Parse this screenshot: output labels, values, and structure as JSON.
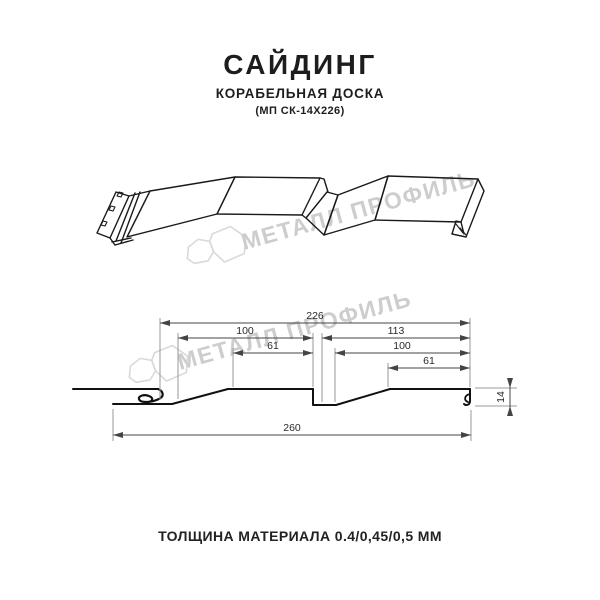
{
  "header": {
    "title": "САЙДИНГ",
    "subtitle": "КОРАБЕЛЬНАЯ ДОСКА",
    "model": "(МП СК-14Х226)"
  },
  "watermark": {
    "brand": "МЕТАЛЛ ПРОФИЛЬ",
    "color": "#cdcdcd",
    "logo_icon": "metall-profil-logo"
  },
  "drawing": {
    "line_color": "#1a1a1a",
    "dimension_color": "#444444",
    "extension_color": "#9a9a9a",
    "dims": {
      "total_top": "226",
      "left_panel": "100",
      "left_flat": "61",
      "right_panel": "113",
      "right_inner": "100",
      "right_flat": "61",
      "overall_width": "260",
      "profile_height": "14"
    }
  },
  "footer": {
    "text": "ТОЛЩИНА МАТЕРИАЛА 0.4/0,45/0,5 ММ"
  }
}
